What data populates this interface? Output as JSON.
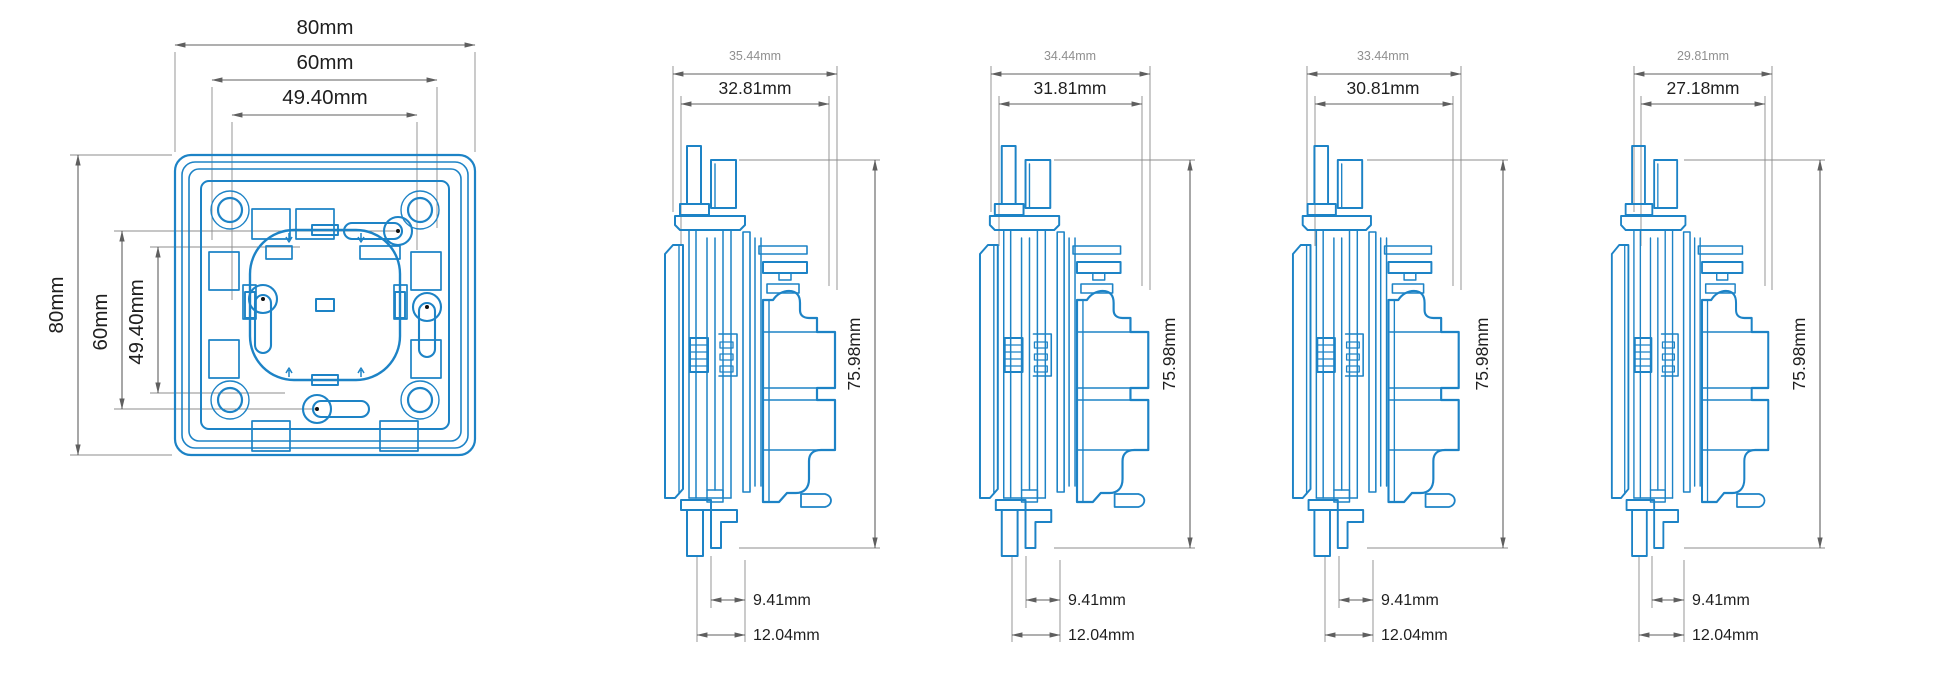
{
  "drawing_title": "switch-frame-dimension-drawing",
  "colors": {
    "line_blue": "#1d83c6",
    "dim_line_gray": "#5f5f5f",
    "extension_line_gray": "#8c8c8c",
    "label_dark": "#1f1f1f",
    "label_light": "#8f8f8f",
    "background": "#ffffff"
  },
  "front_view": {
    "top_dims": [
      "80mm",
      "60mm",
      "49.40mm"
    ],
    "left_dims": [
      "80mm",
      "60mm",
      "49.40mm"
    ]
  },
  "side_views": [
    {
      "outer_width": "35.44mm",
      "inner_width": "32.81mm",
      "height": "75.98mm",
      "clip_depth": "9.41mm",
      "total_depth": "12.04mm"
    },
    {
      "outer_width": "34.44mm",
      "inner_width": "31.81mm",
      "height": "75.98mm",
      "clip_depth": "9.41mm",
      "total_depth": "12.04mm"
    },
    {
      "outer_width": "33.44mm",
      "inner_width": "30.81mm",
      "height": "75.98mm",
      "clip_depth": "9.41mm",
      "total_depth": "12.04mm"
    },
    {
      "outer_width": "29.81mm",
      "inner_width": "27.18mm",
      "height": "75.98mm",
      "clip_depth": "9.41mm",
      "total_depth": "12.04mm"
    }
  ]
}
